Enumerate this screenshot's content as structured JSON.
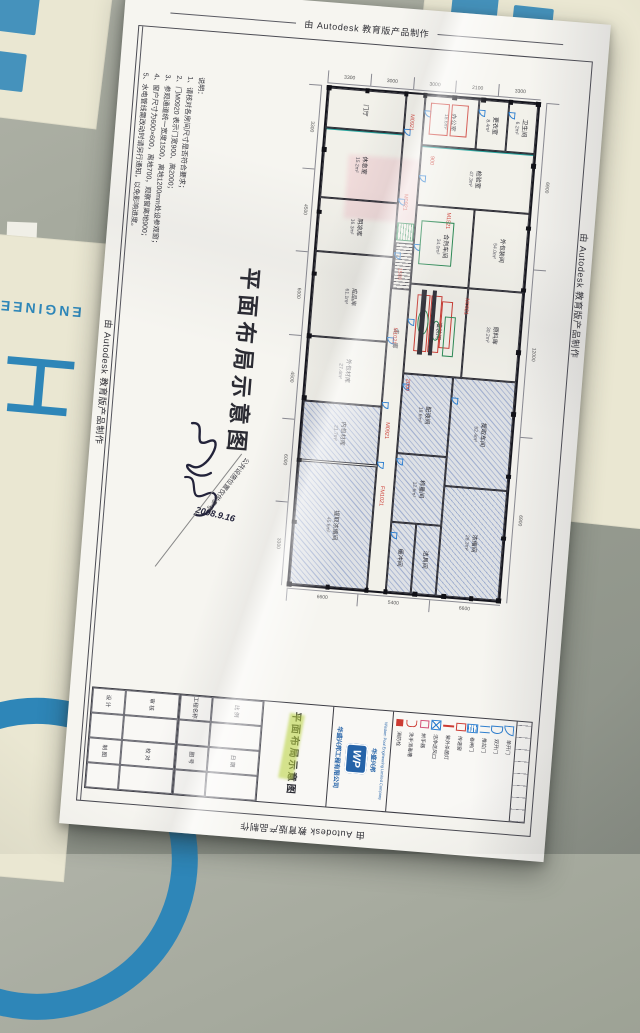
{
  "meta": {
    "watermark": "由 Autodesk 教育版产品制作"
  },
  "background": {
    "address_fragment": "社址：成都市",
    "left_big_char": "工",
    "left_arc_text": "ENGINEE",
    "colors": {
      "banner_bg": "#eae7d2",
      "banner_blue": "#2e86b8",
      "concrete": "#9da295",
      "paper": "#f6f5f0"
    }
  },
  "drawing": {
    "main_title": "平面布局示意图",
    "side_note": "公共设施位置仅供参考",
    "signature_date": "2008.9.16",
    "notes": {
      "heading": "说明：",
      "lines": [
        "1、请核对各房间尺寸是否符合要求；",
        "2、门M0920 表示门宽900、高2000；",
        "3、参观通道统一宽度1500，离地1200mm处设参观窗；",
        "4、窗户尺寸为600×600，离地700，观察窗离地900；",
        "5、水电管线需改动时请另行通知，以免影响进度。"
      ]
    },
    "plan": {
      "corridor_label": "走廊",
      "rooms": [
        {
          "label": "门厅",
          "area": "",
          "x": 0,
          "y": 0,
          "w": 37,
          "h": 8
        },
        {
          "label": "休息室",
          "area": "15.2m²",
          "x": 0,
          "y": 8,
          "w": 37,
          "h": 14
        },
        {
          "label": "阴凉库",
          "area": "16.3m²",
          "x": 0,
          "y": 22,
          "w": 37,
          "h": 11
        },
        {
          "label": "成品库",
          "area": "61.1m²",
          "x": 0,
          "y": 33,
          "w": 37,
          "h": 17
        },
        {
          "label": "外包材库",
          "area": "27.4m²",
          "x": 0,
          "y": 50,
          "w": 37,
          "h": 13
        },
        {
          "label": "内包材库",
          "area": "21.7m²",
          "x": 0,
          "y": 63,
          "w": 37,
          "h": 12,
          "hatched": true
        },
        {
          "label": "提取浓缩间",
          "area": "45.6m²",
          "x": 0,
          "y": 75,
          "w": 37,
          "h": 25,
          "hatched": true
        },
        {
          "label": "办公室",
          "area": "18.6m²",
          "x": 46,
          "y": 0,
          "w": 26,
          "h": 10
        },
        {
          "label": "更衣室",
          "area": "8.4m²",
          "x": 72,
          "y": 0,
          "w": 14,
          "h": 10
        },
        {
          "label": "卫生间",
          "area": "6.2m²",
          "x": 86,
          "y": 0,
          "w": 14,
          "h": 10
        },
        {
          "label": "检验室",
          "area": "47.3m²",
          "x": 46,
          "y": 10,
          "w": 54,
          "h": 12
        },
        {
          "label": "合剂车间",
          "area": "34.0m²",
          "x": 46,
          "y": 22,
          "w": 28,
          "h": 16
        },
        {
          "label": "外包装间",
          "area": "54.0m²",
          "x": 74,
          "y": 22,
          "w": 26,
          "h": 16
        },
        {
          "label": "灌装间",
          "area": "33.2m²",
          "x": 46,
          "y": 38,
          "w": 28,
          "h": 18
        },
        {
          "label": "原料库",
          "area": "30.2m²",
          "x": 74,
          "y": 38,
          "w": 26,
          "h": 18
        },
        {
          "label": "配液间",
          "area": "19.6m²",
          "x": 46,
          "y": 56,
          "w": 24,
          "h": 16,
          "hatched": true
        },
        {
          "label": "称量间",
          "area": "12.6m²",
          "x": 46,
          "y": 72,
          "w": 24,
          "h": 14,
          "hatched": true
        },
        {
          "label": "缓冲间",
          "area": "",
          "x": 46,
          "y": 86,
          "w": 12,
          "h": 14,
          "hatched": true
        },
        {
          "label": "洁具间",
          "area": "",
          "x": 58,
          "y": 86,
          "w": 12,
          "h": 14,
          "hatched": true
        },
        {
          "label": "提取车间",
          "area": "52.4m²",
          "x": 70,
          "y": 56,
          "w": 30,
          "h": 22,
          "hatched": true
        },
        {
          "label": "浓缩间",
          "area": "28.3m²",
          "x": 70,
          "y": 78,
          "w": 30,
          "h": 22,
          "hatched": true
        }
      ],
      "annotations": [
        {
          "t": "M0921",
          "x": 39,
          "y": 4
        },
        {
          "t": "900",
          "x": 50,
          "y": 12
        },
        {
          "t": "M0921",
          "x": 39,
          "y": 20
        },
        {
          "t": "M1521",
          "x": 60,
          "y": 23
        },
        {
          "t": "1500",
          "x": 39,
          "y": 35
        },
        {
          "t": "M1021",
          "x": 39,
          "y": 47
        },
        {
          "t": "2000",
          "x": 47,
          "y": 57
        },
        {
          "t": "M0921",
          "x": 39,
          "y": 66
        },
        {
          "t": "FM1021",
          "x": 39,
          "y": 79
        },
        {
          "t": "M0921",
          "x": 72,
          "y": 40
        }
      ],
      "red_boxes": [
        {
          "x": 49,
          "y": 1.5,
          "w": 8,
          "h": 6
        },
        {
          "x": 59,
          "y": 1.5,
          "w": 7,
          "h": 6
        },
        {
          "x": 50,
          "y": 40,
          "w": 5,
          "h": 11
        },
        {
          "x": 56.5,
          "y": 40,
          "w": 4.5,
          "h": 11
        },
        {
          "x": 62,
          "y": 41,
          "w": 4,
          "h": 9
        }
      ],
      "equipment": [
        {
          "type": "rect",
          "x": 49,
          "y": 25,
          "w": 16,
          "h": 9
        },
        {
          "type": "grid",
          "x": 37.5,
          "y": 26,
          "w": 8,
          "h": 3.5
        },
        {
          "type": "circle",
          "x": 51,
          "y": 43,
          "w": 5,
          "h": 5
        },
        {
          "type": "circle",
          "x": 58,
          "y": 45,
          "w": 4,
          "h": 4
        },
        {
          "type": "dark",
          "x": 52,
          "y": 39,
          "w": 2.5,
          "h": 13
        },
        {
          "type": "dark",
          "x": 57,
          "y": 39,
          "w": 2,
          "h": 13
        },
        {
          "type": "rect",
          "x": 64,
          "y": 44,
          "w": 5,
          "h": 8
        }
      ],
      "doors": [
        {
          "x": 37,
          "y": 7
        },
        {
          "x": 46,
          "y": 3
        },
        {
          "x": 72,
          "y": 2
        },
        {
          "x": 86,
          "y": 2
        },
        {
          "x": 37,
          "y": 21
        },
        {
          "x": 46,
          "y": 16
        },
        {
          "x": 37,
          "y": 32
        },
        {
          "x": 46,
          "y": 30
        },
        {
          "x": 37,
          "y": 49
        },
        {
          "x": 46,
          "y": 45
        },
        {
          "x": 37,
          "y": 62
        },
        {
          "x": 46,
          "y": 58
        },
        {
          "x": 37,
          "y": 74
        },
        {
          "x": 46,
          "y": 73
        },
        {
          "x": 46,
          "y": 88
        },
        {
          "x": 70,
          "y": 60
        }
      ],
      "dims": {
        "top": [
          "3300",
          "3000",
          "3000",
          "2100",
          "3300"
        ],
        "left": [
          "3300",
          "4500",
          "6000",
          "4500",
          "6000",
          "3300"
        ],
        "right": [
          "6900",
          "12000",
          "6900"
        ],
        "bottom": [
          "6600",
          "5400",
          "6600"
        ]
      }
    },
    "title_block": {
      "logo": "WP",
      "logo_caption": "华盛兴邦",
      "company": "华盛兴邦工程有限公司",
      "company_en": "Wisdom Pool Engineering Limited Company",
      "drawing_name": "平面布局示意图",
      "fields_a": [
        "设 计",
        "制 图",
        "审 核",
        "校 对"
      ],
      "fields_b": [
        "工程名称",
        "图 号",
        "比 例",
        "日 期"
      ],
      "legend": [
        {
          "label": "消防栓",
          "type": "hydrant"
        },
        {
          "label": "洗手消毒槽",
          "type": "sink"
        },
        {
          "label": "烘手器",
          "type": "dryer"
        },
        {
          "label": "洁净送风口",
          "type": "air"
        },
        {
          "label": "紫外杀菌灯",
          "type": "uv"
        },
        {
          "label": "传递窗",
          "type": "pass"
        },
        {
          "label": "卷闸门",
          "type": "roll"
        },
        {
          "label": "推拉门",
          "type": "slide"
        },
        {
          "label": "双开门",
          "type": "door2"
        },
        {
          "label": "单开门",
          "type": "door1"
        }
      ]
    }
  }
}
